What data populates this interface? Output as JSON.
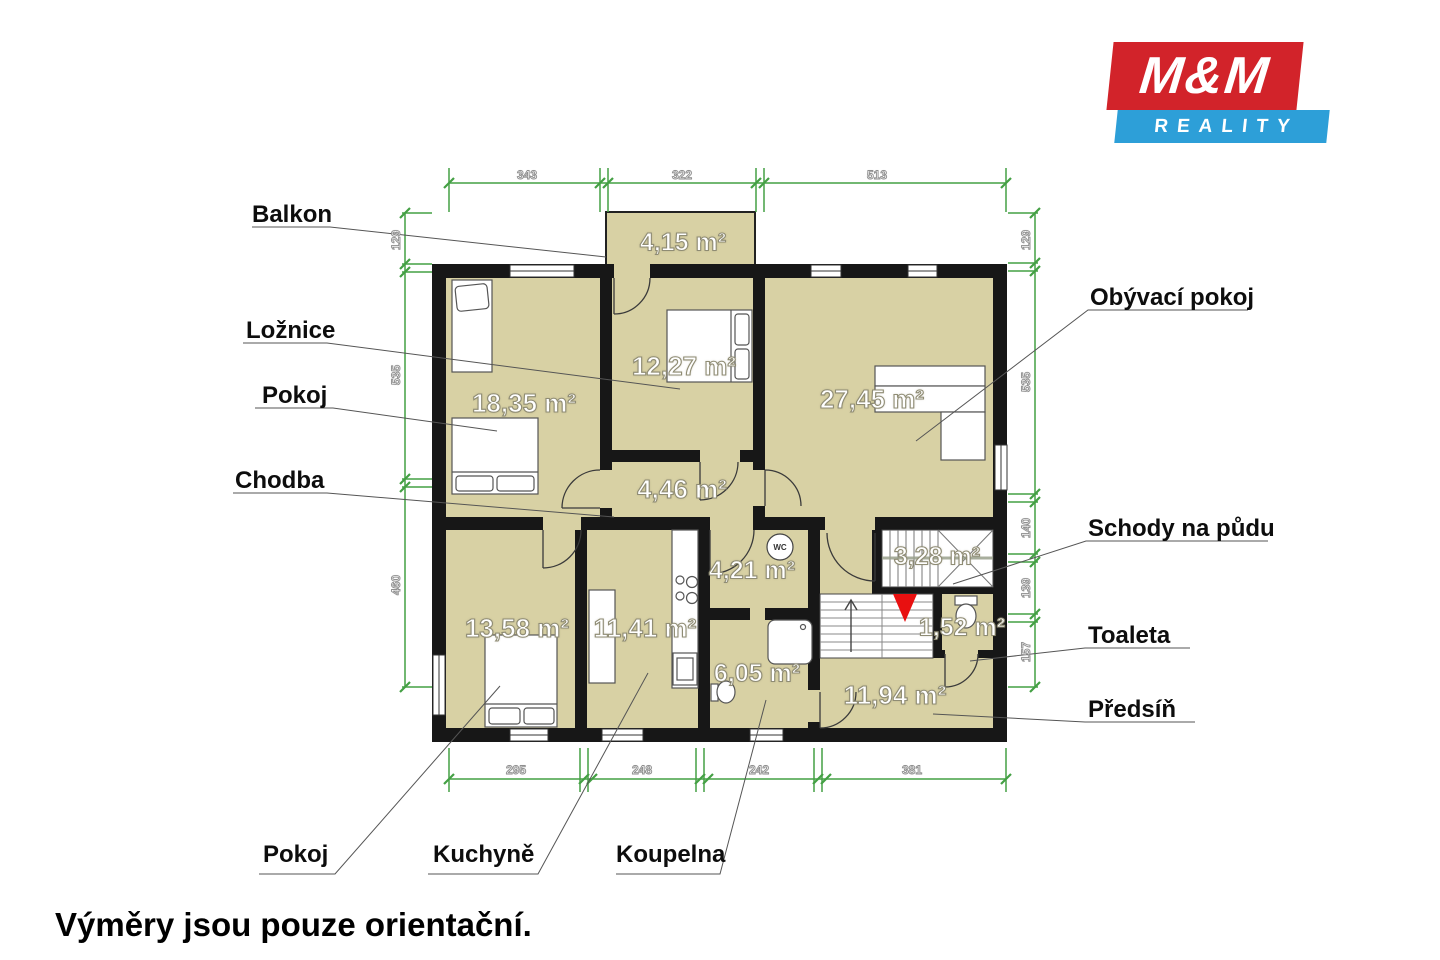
{
  "logo": {
    "mm": "M&M",
    "reality": "REALITY",
    "red": "#d2232a",
    "blue": "#2d9fd8"
  },
  "note": "Výměry jsou pouze orientační.",
  "wc_icon_label": "WC",
  "labels": {
    "balkon": "Balkon",
    "loznice": "Ložnice",
    "pokoj_left": "Pokoj",
    "chodba": "Chodba",
    "obyvaci": "Obývací pokoj",
    "schody": "Schody na půdu",
    "toaleta": "Toaleta",
    "predsin": "Předsíň",
    "pokoj_bottom": "Pokoj",
    "kuchyne": "Kuchyně",
    "koupelna": "Koupelna"
  },
  "areas": {
    "balkon": "4,15 m²",
    "pokoj_left": "18,35 m²",
    "loznice": "12,27 m²",
    "obyvaci": "27,45 m²",
    "chodba": "4,46 m²",
    "wc_room": "4,21 m²",
    "pokoj_bottom": "13,58 m²",
    "kuchyne": "11,41 m²",
    "koupelna": "6,05 m²",
    "schody": "3,28 m²",
    "toaleta": "1,52 m²",
    "predsin": "11,94 m²"
  },
  "dimensions": {
    "top": [
      "343",
      "322",
      "513"
    ],
    "bottom": [
      "295",
      "248",
      "242",
      "381"
    ],
    "left": [
      "129",
      "535",
      "460"
    ],
    "right": [
      "129",
      "535",
      "140",
      "139",
      "157"
    ]
  },
  "colors": {
    "room_fill": "#d8d1a4",
    "wall": "#171717",
    "dimension_green": "#44a044",
    "arrow_red": "#e81010"
  }
}
